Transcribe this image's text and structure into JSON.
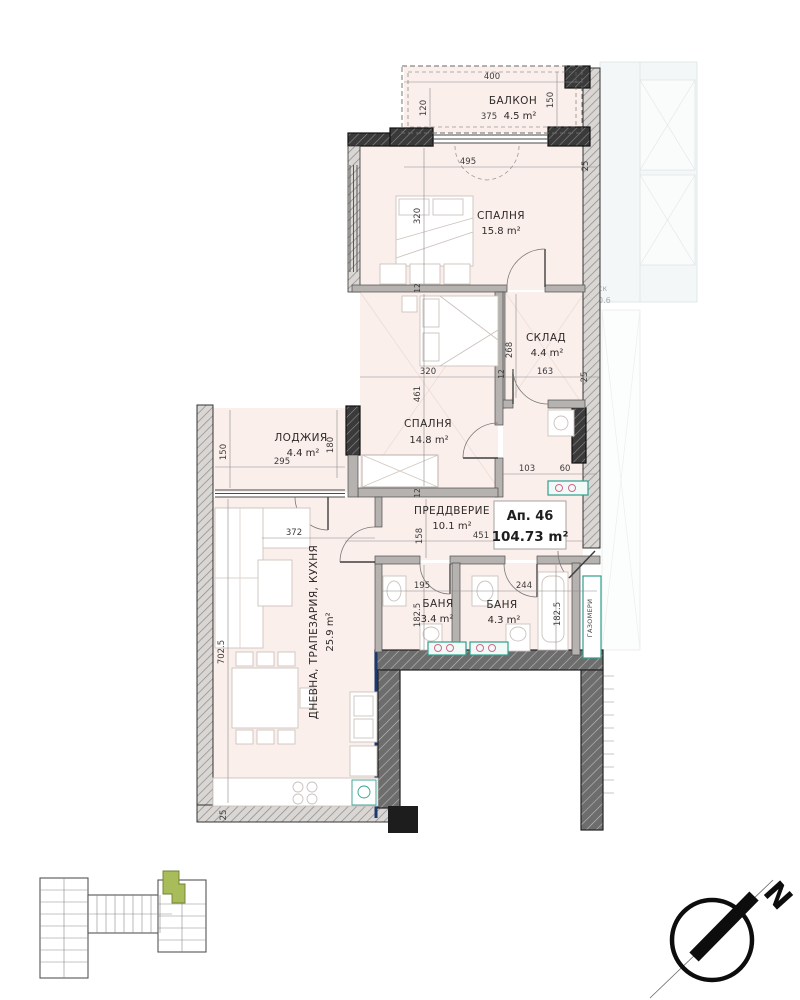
{
  "plan": {
    "apartment": {
      "number": "Ап. 46",
      "area": "104.73 m²"
    },
    "rooms": [
      {
        "name": "БАЛКОН",
        "area": "4.5 m²"
      },
      {
        "name": "СПАЛНЯ",
        "area": "15.8 m²"
      },
      {
        "name": "СКЛАД",
        "area": "4.4 m²"
      },
      {
        "name": "СПАЛНЯ",
        "area": "14.8 m²"
      },
      {
        "name": "ЛОДЖИЯ",
        "area": "4.4 m²"
      },
      {
        "name": "ПРЕДДВЕРИЕ",
        "area": "10.1 m²"
      },
      {
        "name": "БАНЯ",
        "area": "3.4 m²"
      },
      {
        "name": "БАНЯ",
        "area": "4.3 m²"
      },
      {
        "name": "ДНЕВНА, ТРАПЕЗАРИЯ, КУХНЯ",
        "area": "25.9 m²"
      }
    ],
    "annotations": {
      "gas_meters": "ГАЗОМЕРИ",
      "north": "N",
      "adjacent_room_partial": "ск",
      "adjacent_area_partial": "0.6"
    },
    "dimensions": {
      "balcony_width": "400",
      "balcony_depth_left": "120",
      "balcony_depth_right": "150",
      "balcony_inner": "375",
      "bedroom1_window": "495",
      "party_wall_top": "25",
      "bedroom1_depth": "320",
      "wall_12_a": "12",
      "wall_30": "30",
      "storage_depth": "268",
      "bedroom2_width": "320",
      "wall_12_b": "12",
      "storage_width": "163",
      "party_wall_mid": "25",
      "bedroom2_depth": "461",
      "wall_12_c": "12",
      "loggia_depth": "150",
      "loggia_width": "295",
      "loggia_right": "180",
      "niche_width": "103",
      "shaft_width": "60",
      "hall_depth": "158",
      "hall_width": "451",
      "living_width": "372",
      "bath1_width": "195",
      "bath2_width": "244",
      "bath1_depth": "182.5",
      "bath2_depth": "182.5",
      "living_depth": "702.5",
      "living_wall_bottom": "25"
    },
    "colors": {
      "room_fill": "#fbefec",
      "accent_teal": "#2f9e8e",
      "accent_pink": "#d4668c",
      "accent_navy": "#1d3a6e",
      "key_plan_highlight": "#a9bc5a"
    }
  }
}
